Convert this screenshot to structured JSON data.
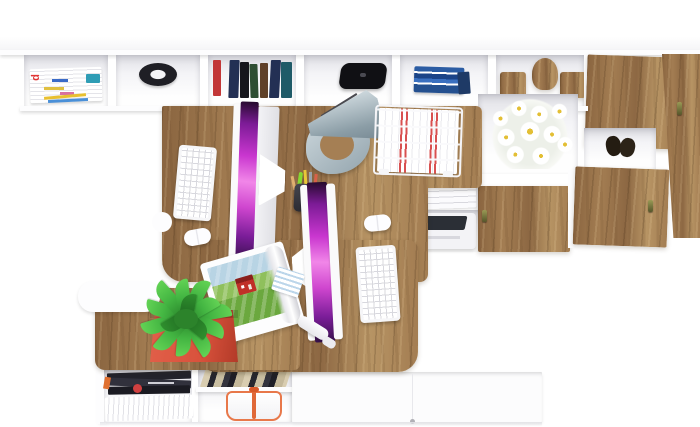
{
  "meta": {
    "type": "3d-render",
    "view": "top-down",
    "subject": "white and oak home office with two computer workstations, wall shelving and cabinets"
  },
  "text": {
    "magazine_spine_letter": "d"
  },
  "palette": {
    "bg": "#ffffff",
    "panel": "#fdfdfe",
    "shadow-soft": "#e6e6ea",
    "wood": "#a37d52",
    "wood-dark": "#8a6540",
    "wood-light": "#b79464",
    "wood-deep": "#8d6843",
    "screen-hi": "#f186e8",
    "screen-mid": "#c936cf",
    "screen-deep": "#35104a",
    "lamp-light": "#cdd8dd",
    "lamp-dark": "#7a8c96",
    "plant": "#43b542",
    "plant-dark": "#257c26",
    "pot": "#d9523c",
    "basket": "#e8784a",
    "daisy": "#e3bf35",
    "book-navy": "#233054",
    "book-black": "#16161c",
    "book-green": "#2f4f33",
    "book-brown": "#5f4028",
    "book-teal": "#1f5b68",
    "book-red": "#c23737",
    "book-blue": "#2b5ca3",
    "tab-pink": "#e84a8a",
    "tab-blue": "#3a7ae0",
    "tab-yellow": "#f0c030",
    "tab-green": "#40b050",
    "handle-olive": "#55552a",
    "ink-dark": "#23232b"
  },
  "inventory": {
    "wall_shelf": [
      "magazine stack",
      "black round tray",
      "row of hardcover books",
      "black speaker",
      "stack of blue books",
      "wooden toy blocks"
    ],
    "desk": [
      "two white monitors with magenta screens",
      "two white keyboards",
      "two white mice",
      "gray desk lamp",
      "pen cup with pens",
      "white wire letter tray with documents",
      "open magazine with red house photo",
      "white stylus",
      "blue notepad"
    ],
    "cabinet": [
      "white daisy bouquet",
      "white binders with colored index tabs",
      "white printer with dark lid",
      "oak doors with small handles",
      "dark shoes"
    ],
    "bench": [
      "green houseplant in coral pot"
    ],
    "bottom_shelf": [
      "pile of dark magazines",
      "fanned white papers",
      "striped leaning books",
      "coral wire basket",
      "white drawer fronts"
    ]
  }
}
